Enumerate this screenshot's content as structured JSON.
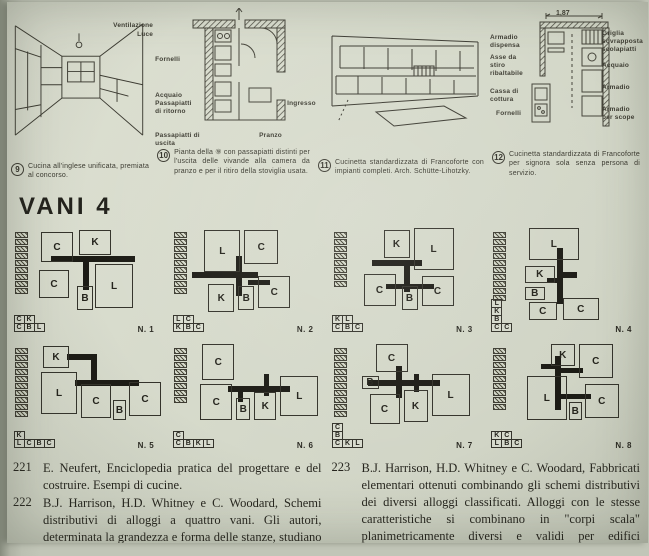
{
  "colors": {
    "photo_bg": "#bcc0b2",
    "page_bg": "#d6dacb",
    "ink": "#3c3b32",
    "corridor_black": "#1c1b15"
  },
  "figures": [
    {
      "number": "9",
      "labels": [
        "Ventilazione",
        "Luce"
      ],
      "caption": "Cucina all'inglese unificata, premiata al concorso."
    },
    {
      "number": "10",
      "labels": [
        "Fornelli",
        "Acquaio Passapiatti di ritorno",
        "Passapiatti di uscita",
        "Ingresso",
        "Pranzo"
      ],
      "caption": "Pianta della ⑨ con passapiatti distinti per l'uscita delle vivande alla camera da pranzo e per il ritiro della stoviglia usata."
    },
    {
      "number": "11",
      "labels": [],
      "caption": "Cucinetta standardizzata di Francoforte con impianti completi. Arch. Schütte-Lihotzky."
    },
    {
      "number": "12",
      "dimension": "1,87",
      "labels_left": [
        "Armadio dispensa",
        "Asse da stiro ribaltabile",
        "Cassa di cottura",
        "Fornelli"
      ],
      "labels_right": [
        "Griglia sovrapposta scolapiatti",
        "Acquaio",
        "Armadio",
        "Armadio per scope"
      ],
      "caption": "Cucinetta standardizzata di Francoforte per signora sola senza persona di servizio."
    }
  ],
  "section": {
    "title": "VANI 4"
  },
  "schemes": [
    {
      "name": "N. 1",
      "stack_cells": 9,
      "legend": [
        "CK",
        "CBL"
      ],
      "rooms": [
        {
          "label": "C",
          "x": 8,
          "y": 4,
          "w": 32,
          "h": 30
        },
        {
          "label": "K",
          "x": 46,
          "y": 2,
          "w": 32,
          "h": 25
        },
        {
          "label": "C",
          "x": 6,
          "y": 42,
          "w": 30,
          "h": 28
        },
        {
          "label": "L",
          "x": 62,
          "y": 36,
          "w": 38,
          "h": 44
        },
        {
          "label": "B",
          "x": 44,
          "y": 58,
          "w": 16,
          "h": 24
        }
      ],
      "bars": [
        {
          "x": 18,
          "y": 28,
          "w": 84,
          "h": 6
        },
        {
          "x": 50,
          "y": 30,
          "w": 6,
          "h": 32
        }
      ]
    },
    {
      "name": "N. 2",
      "stack_cells": 9,
      "legend": [
        "LC",
        "KBC"
      ],
      "rooms": [
        {
          "label": "L",
          "x": 12,
          "y": 2,
          "w": 36,
          "h": 42
        },
        {
          "label": "C",
          "x": 52,
          "y": 2,
          "w": 34,
          "h": 34
        },
        {
          "label": "K",
          "x": 16,
          "y": 56,
          "w": 26,
          "h": 28
        },
        {
          "label": "B",
          "x": 46,
          "y": 58,
          "w": 16,
          "h": 24
        },
        {
          "label": "C",
          "x": 66,
          "y": 48,
          "w": 32,
          "h": 32
        }
      ],
      "bars": [
        {
          "x": 0,
          "y": 44,
          "w": 66,
          "h": 6
        },
        {
          "x": 44,
          "y": 28,
          "w": 6,
          "h": 40
        },
        {
          "x": 56,
          "y": 52,
          "w": 22,
          "h": 5
        }
      ]
    },
    {
      "name": "N. 3",
      "stack_cells": 8,
      "legend": [
        "KL",
        "CBC"
      ],
      "rooms": [
        {
          "label": "K",
          "x": 32,
          "y": 2,
          "w": 26,
          "h": 28
        },
        {
          "label": "L",
          "x": 62,
          "y": 0,
          "w": 40,
          "h": 42
        },
        {
          "label": "C",
          "x": 12,
          "y": 46,
          "w": 32,
          "h": 32
        },
        {
          "label": "B",
          "x": 50,
          "y": 58,
          "w": 16,
          "h": 24
        },
        {
          "label": "C",
          "x": 70,
          "y": 48,
          "w": 32,
          "h": 30
        }
      ],
      "bars": [
        {
          "x": 20,
          "y": 32,
          "w": 50,
          "h": 6
        },
        {
          "x": 52,
          "y": 34,
          "w": 6,
          "h": 30
        },
        {
          "x": 34,
          "y": 56,
          "w": 48,
          "h": 5
        }
      ]
    },
    {
      "name": "N. 4",
      "stack_cells": 10,
      "legend": [
        "L",
        "K",
        "B",
        "CC"
      ],
      "rooms": [
        {
          "label": "L",
          "x": 18,
          "y": 0,
          "w": 50,
          "h": 32
        },
        {
          "label": "K",
          "x": 14,
          "y": 38,
          "w": 30,
          "h": 17
        },
        {
          "label": "B",
          "x": 14,
          "y": 59,
          "w": 20,
          "h": 13
        },
        {
          "label": "C",
          "x": 18,
          "y": 74,
          "w": 28,
          "h": 18
        },
        {
          "label": "C",
          "x": 52,
          "y": 70,
          "w": 36,
          "h": 22
        }
      ],
      "bars": [
        {
          "x": 46,
          "y": 20,
          "w": 6,
          "h": 56
        },
        {
          "x": 52,
          "y": 44,
          "w": 14,
          "h": 6
        },
        {
          "x": 36,
          "y": 50,
          "w": 10,
          "h": 5
        }
      ]
    },
    {
      "name": "N. 5",
      "stack_cells": 10,
      "legend": [
        "K",
        "LCBC"
      ],
      "rooms": [
        {
          "label": "K",
          "x": 10,
          "y": 2,
          "w": 26,
          "h": 22
        },
        {
          "label": "L",
          "x": 8,
          "y": 28,
          "w": 36,
          "h": 42
        },
        {
          "label": "C",
          "x": 48,
          "y": 40,
          "w": 30,
          "h": 34
        },
        {
          "label": "B",
          "x": 80,
          "y": 56,
          "w": 13,
          "h": 20
        },
        {
          "label": "C",
          "x": 96,
          "y": 38,
          "w": 32,
          "h": 34
        }
      ],
      "bars": [
        {
          "x": 34,
          "y": 10,
          "w": 28,
          "h": 6
        },
        {
          "x": 58,
          "y": 10,
          "w": 6,
          "h": 30
        },
        {
          "x": 42,
          "y": 36,
          "w": 64,
          "h": 6
        }
      ]
    },
    {
      "name": "N. 6",
      "stack_cells": 8,
      "legend": [
        "C",
        "CBKL"
      ],
      "rooms": [
        {
          "label": "C",
          "x": 10,
          "y": 0,
          "w": 32,
          "h": 36
        },
        {
          "label": "C",
          "x": 8,
          "y": 40,
          "w": 32,
          "h": 36
        },
        {
          "label": "B",
          "x": 44,
          "y": 54,
          "w": 14,
          "h": 22
        },
        {
          "label": "K",
          "x": 62,
          "y": 48,
          "w": 22,
          "h": 28
        },
        {
          "label": "L",
          "x": 88,
          "y": 32,
          "w": 38,
          "h": 40
        }
      ],
      "bars": [
        {
          "x": 36,
          "y": 42,
          "w": 62,
          "h": 6
        },
        {
          "x": 46,
          "y": 42,
          "w": 5,
          "h": 16
        },
        {
          "x": 72,
          "y": 30,
          "w": 5,
          "h": 22
        }
      ]
    },
    {
      "name": "N. 7",
      "stack_cells": 10,
      "legend": [
        "C",
        "B",
        "CKL"
      ],
      "rooms": [
        {
          "label": "C",
          "x": 24,
          "y": 0,
          "w": 32,
          "h": 28
        },
        {
          "label": "B",
          "x": 10,
          "y": 32,
          "w": 17,
          "h": 13
        },
        {
          "label": "C",
          "x": 18,
          "y": 50,
          "w": 30,
          "h": 30
        },
        {
          "label": "K",
          "x": 52,
          "y": 46,
          "w": 24,
          "h": 32
        },
        {
          "label": "L",
          "x": 80,
          "y": 30,
          "w": 38,
          "h": 42
        }
      ],
      "bars": [
        {
          "x": 16,
          "y": 36,
          "w": 72,
          "h": 6
        },
        {
          "x": 44,
          "y": 22,
          "w": 6,
          "h": 32
        },
        {
          "x": 62,
          "y": 30,
          "w": 5,
          "h": 18
        }
      ]
    },
    {
      "name": "N. 8",
      "stack_cells": 9,
      "legend": [
        "KC",
        "LBC"
      ],
      "rooms": [
        {
          "label": "K",
          "x": 40,
          "y": 0,
          "w": 24,
          "h": 22
        },
        {
          "label": "C",
          "x": 68,
          "y": 0,
          "w": 34,
          "h": 34
        },
        {
          "label": "L",
          "x": 16,
          "y": 32,
          "w": 40,
          "h": 44
        },
        {
          "label": "B",
          "x": 58,
          "y": 58,
          "w": 13,
          "h": 18
        },
        {
          "label": "C",
          "x": 74,
          "y": 40,
          "w": 34,
          "h": 34
        }
      ],
      "bars": [
        {
          "x": 44,
          "y": 12,
          "w": 6,
          "h": 54
        },
        {
          "x": 30,
          "y": 20,
          "w": 16,
          "h": 5
        },
        {
          "x": 44,
          "y": 24,
          "w": 28,
          "h": 5
        },
        {
          "x": 48,
          "y": 50,
          "w": 32,
          "h": 5
        }
      ]
    }
  ],
  "bibliography": {
    "left": [
      {
        "num": "221",
        "text": "E. Neufert, Enciclopedia pratica del progettare e del costruire. Esempi di cucine."
      },
      {
        "num": "222",
        "text": "B.J. Harrison, H.D. Whitney e C. Woodard, Schemi distributivi di alloggi a quattro vani. Gli autori, determinata la grandezza e forma delle stanze, studiano diverse distribuzioni per alloggi dello stesso taglio che, se rispondenti ai"
      }
    ],
    "right": [
      {
        "num": "223",
        "text": "B.J. Harrison, H.D. Whitney e C. Woodard, Fabbricati elementari ottenuti combinando gli schemi distributivi dei diversi alloggi classificati. Alloggi con le stesse caratteristiche si combinano in \"corpi scala\" planimetricamente diversi e validi per edifici residenziali con configurazioni volumetriche, dimensioni e ruoli urbani differenti."
      }
    ]
  }
}
